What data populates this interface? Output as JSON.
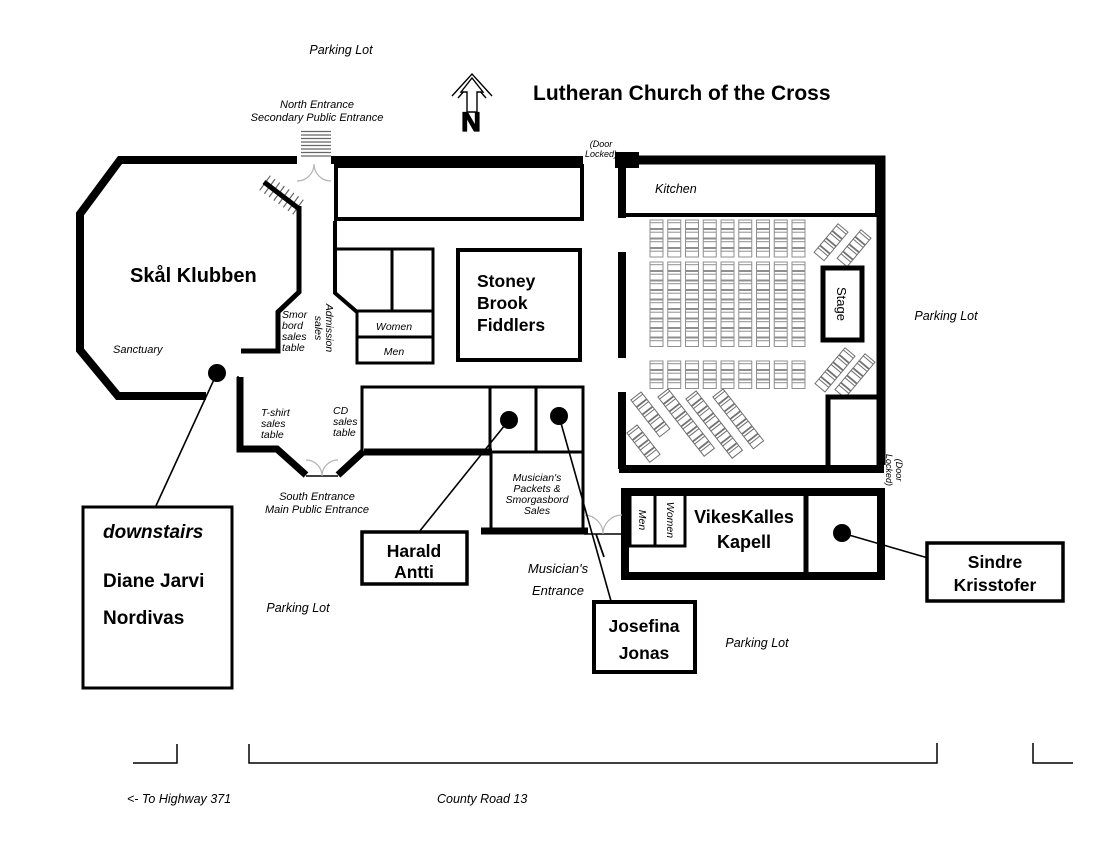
{
  "page": {
    "title": "Lutheran Church of the Cross"
  },
  "compass": {
    "letter": "N"
  },
  "areas": {
    "skal_klubben": "Skål Klubben",
    "sanctuary": "Sanctuary",
    "kitchen": "Kitchen",
    "stage": "Stage",
    "stoney_brook": {
      "line1": "Stoney",
      "line2": "Brook",
      "line3": "Fiddlers"
    },
    "vikeskalles": {
      "line1": "VikesKalles",
      "line2": "Kapell"
    },
    "restroom_women": "Women",
    "restroom_men": "Men",
    "kapell_men": "Men",
    "kapell_women": "Women"
  },
  "sales": {
    "smorbord": {
      "line1": "Smor",
      "line2": "bord",
      "line3": "sales",
      "line4": "table"
    },
    "admission": {
      "line1": "Admission",
      "line2": "sales"
    },
    "tshirt": {
      "line1": "T-shirt",
      "line2": "sales",
      "line3": "table"
    },
    "cd": {
      "line1": "CD",
      "line2": "sales",
      "line3": "table"
    },
    "musicians_packets": {
      "line1": "Musician's",
      "line2": "Packets &",
      "line3": "Smorgasbord",
      "line4": "Sales"
    }
  },
  "entrances": {
    "north": {
      "line1": "North Entrance",
      "line2": "Secondary Public Entrance"
    },
    "south": {
      "line1": "South Entrance",
      "line2": "Main Public Entrance"
    },
    "musicians": {
      "line1": "Musician's",
      "line2": "Entrance"
    },
    "door_locked_top": {
      "line1": "(Door",
      "line2": "Locked)"
    },
    "door_locked_right": {
      "line1": "(Door",
      "line2": "Locked)"
    }
  },
  "parking": {
    "top": "Parking Lot",
    "right": "Parking Lot",
    "bottom_left": "Parking Lot",
    "bottom_mid": "Parking Lot"
  },
  "roads": {
    "highway": "<- To Highway 371",
    "county": "County Road 13"
  },
  "performers": {
    "downstairs": {
      "tag": "downstairs",
      "line1": "Diane Jarvi",
      "line2": "Nordivas"
    },
    "harald": {
      "line1": "Harald",
      "line2": "Antti"
    },
    "josefina": {
      "line1": "Josefina",
      "line2": "Jonas"
    },
    "sindre": {
      "line1": "Sindre",
      "line2": "Krisstofer"
    }
  },
  "seating": {
    "main_columns": 9,
    "main_row_blocks": [
      4,
      9,
      3
    ],
    "diagonal_floor_strips": 5,
    "stage_side_strips": 4
  },
  "colors": {
    "ink": "#000000",
    "chair_row": "#8f8f8f",
    "chair_diag": "#6f6f6f",
    "door_arc": "#b3b3b3",
    "steps": "#666666"
  }
}
